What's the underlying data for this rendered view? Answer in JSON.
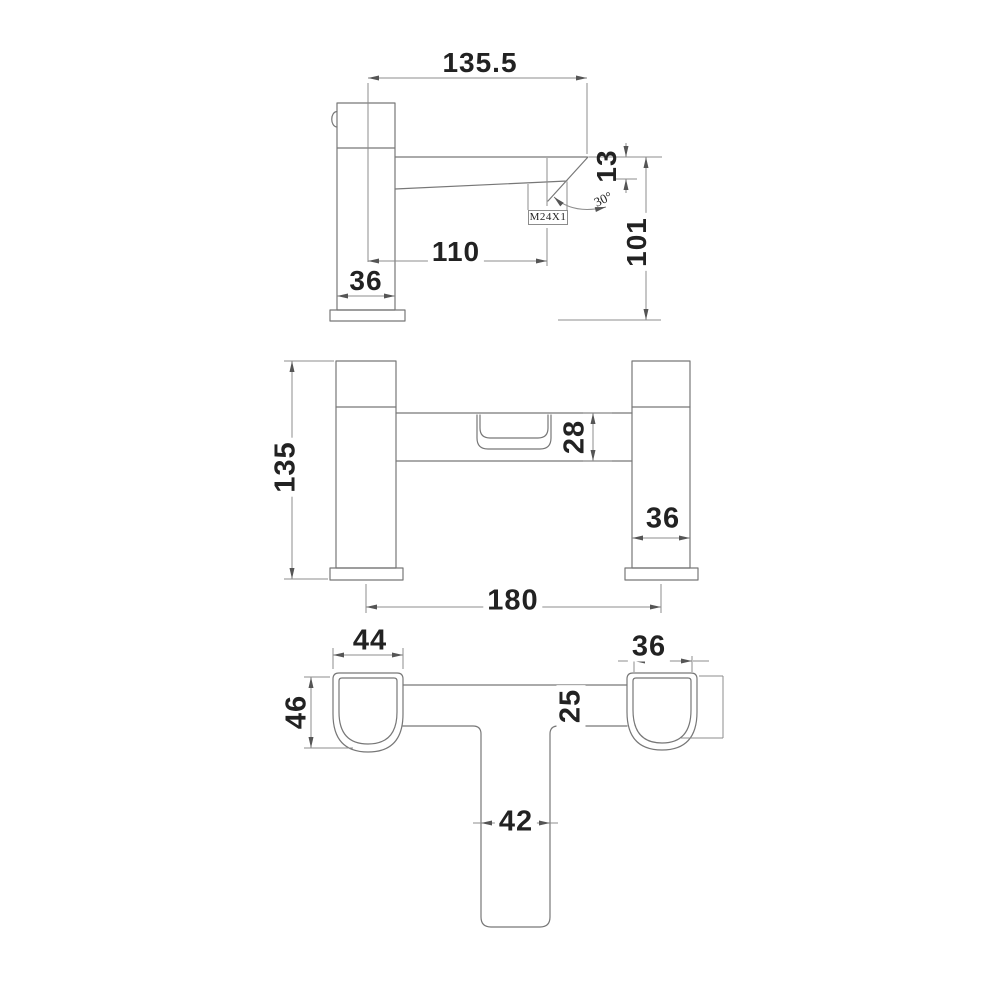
{
  "drawing": {
    "title": "Bath filler tap - dimensioned engineering drawing, three views",
    "units": "mm",
    "colors": {
      "outline": "#777777",
      "dimension": "#8c8c8c",
      "text": "#222222",
      "background": "#ffffff"
    },
    "views": {
      "side": {
        "label": "side-elevation",
        "dims": {
          "overall_reach": "135.5",
          "tip_height": "13",
          "spout_angle": "30°",
          "aerator_thread": "M24X1",
          "spout_projection": "110",
          "body_width": "36",
          "spout_clearance": "101"
        }
      },
      "front": {
        "label": "front-elevation",
        "dims": {
          "overall_height": "135",
          "body_depth": "28",
          "pillar_width": "36",
          "pillar_centres": "180"
        }
      },
      "plan": {
        "label": "plan-view",
        "dims": {
          "left_base_width": "44",
          "right_base_width": "36",
          "base_depth": "46",
          "bridge_depth": "25",
          "spout_width": "42"
        }
      }
    }
  }
}
